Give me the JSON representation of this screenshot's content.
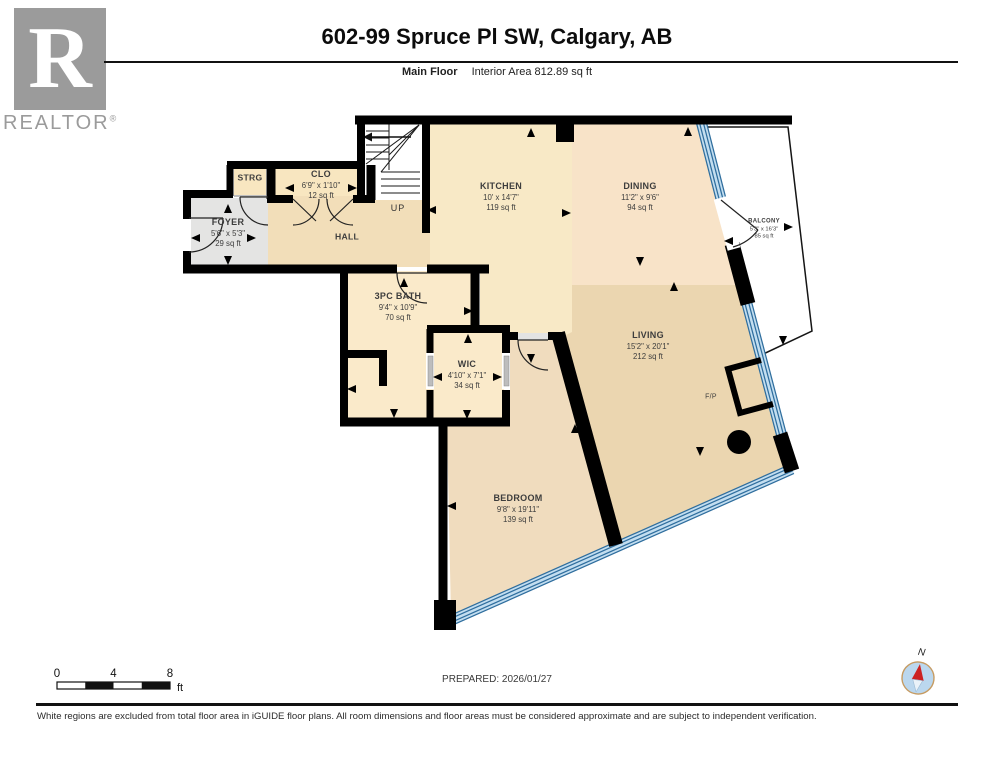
{
  "header": {
    "logo": {
      "letter": "R",
      "text": "REALTOR",
      "reg": "®"
    },
    "title": "602-99 Spruce Pl SW, Calgary, AB",
    "floor_name": "Main Floor",
    "interior_area": "Interior Area 812.89 sq ft"
  },
  "rooms": {
    "strg": {
      "name": "STRG"
    },
    "clo": {
      "name": "CLO",
      "dims": "6'9\" x 1'10\"",
      "area": "12 sq ft"
    },
    "foyer": {
      "name": "FOYER",
      "dims": "5'6\" x 5'3\"",
      "area": "29 sq ft"
    },
    "hall": {
      "name": "HALL"
    },
    "stairs": {
      "direction": "UP"
    },
    "kitchen": {
      "name": "KITCHEN",
      "dims": "10' x 14'7\"",
      "area": "119 sq ft"
    },
    "dining": {
      "name": "DINING",
      "dims": "11'2\" x 9'6\"",
      "area": "94 sq ft"
    },
    "balcony": {
      "name": "BALCONY",
      "dims": "5'3\" x 16'3\"",
      "area": "85 sq ft"
    },
    "bath": {
      "name": "3PC BATH",
      "dims": "9'4\" x 10'9\"",
      "area": "70 sq ft"
    },
    "wic": {
      "name": "WIC",
      "dims": "4'10\" x 7'1\"",
      "area": "34 sq ft"
    },
    "bedroom": {
      "name": "BEDROOM",
      "dims": "9'8\" x 19'11\"",
      "area": "139 sq ft"
    },
    "living": {
      "name": "LIVING",
      "dims": "15'2\" x 20'1\"",
      "area": "212 sq ft"
    },
    "fireplace": {
      "name": "F/P"
    }
  },
  "footer": {
    "scale": {
      "ticks": [
        "0",
        "4",
        "8"
      ],
      "unit": "ft"
    },
    "prepared": "PREPARED: 2026/01/27",
    "compass": {
      "north_label": "N"
    },
    "disclaimer": "White regions are excluded from total floor area in iGUIDE floor plans. All room dimensions and floor areas must be considered approximate and are subject to independent verification."
  },
  "colors": {
    "wall": "#000000",
    "floor_cream": "#F8E9C6",
    "floor_hall": "#F2DEB9",
    "floor_dining": "#F8E3C8",
    "floor_living": "#EBD6B0",
    "floor_bedroom": "#F0DCBE",
    "floor_bath": "#FAEACA",
    "floor_foyer": "#E4E4E3",
    "glazing_dark": "#2F6E9E",
    "glazing_light": "#C3DEF0",
    "compass_needle": "#CC2222",
    "logo_gray": "#9B9B9B"
  }
}
